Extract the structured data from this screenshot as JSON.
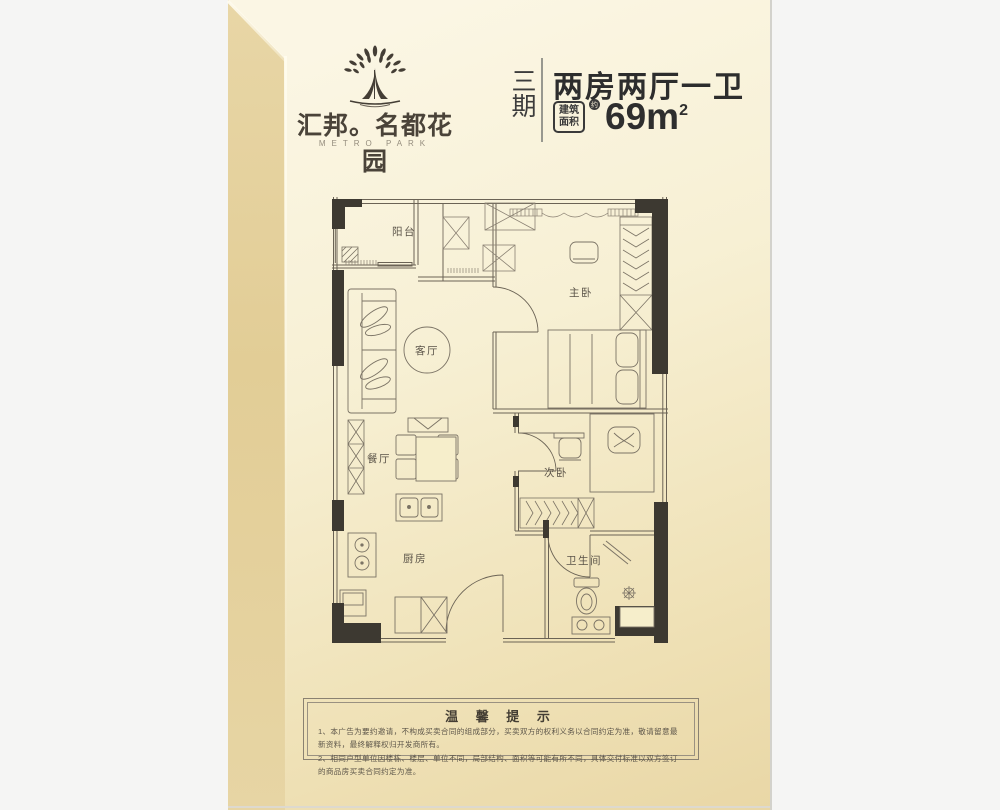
{
  "header": {
    "brand_cn": "汇邦。名都花园",
    "brand_en": "METRO PARK",
    "phase": "三期",
    "title": "两房两厅一卫",
    "area_badge_line1": "建筑",
    "area_badge_line2": "面积",
    "area_approx": "约",
    "area_value": "69m",
    "area_sup": "2"
  },
  "floorplan": {
    "labels": {
      "balcony": "阳台",
      "living": "客厅",
      "dining": "餐厅",
      "master": "主卧",
      "second": "次卧",
      "kitchen": "厨房",
      "bath": "卫生间"
    }
  },
  "notice": {
    "title": "温 馨 提 示",
    "lines": [
      "1、本广告为要约邀请，不构成买卖合同的组成部分，买卖双方的权利义务以合同约定为准，敬请留意最新资料，最终解释权归开发商所有。",
      "2、相同户型单位因楼栋、楼层、单位不同，局部结构、面积等可能有所不同，具体交付标准以双方签订的商品房买卖合同约定为准。"
    ]
  },
  "colors": {
    "page_cream": "#f7f0d4",
    "page_side": "#e2cd96",
    "wall_dark": "#3d3931",
    "line": "#6b6355",
    "text_dark": "#2d2d2d",
    "label": "#5a5348"
  }
}
